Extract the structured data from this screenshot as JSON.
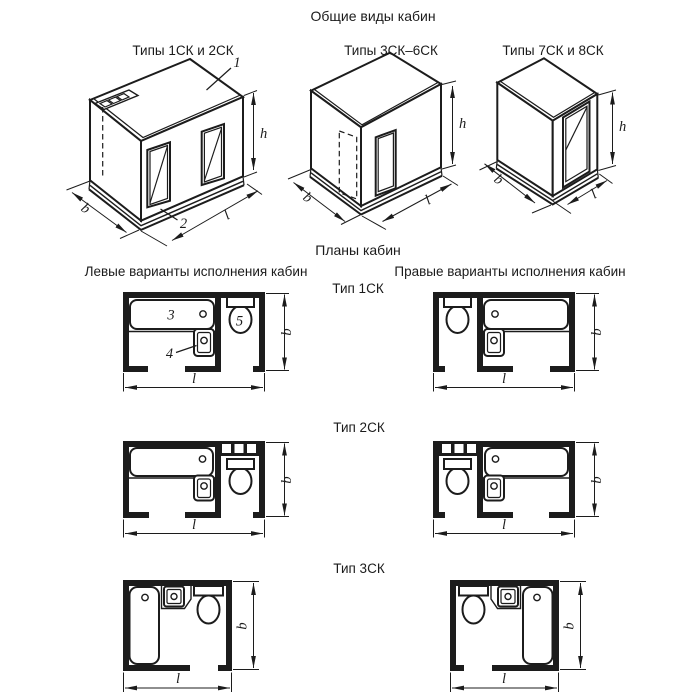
{
  "page": {
    "title": "Общие виды кабин"
  },
  "iso_views": {
    "v1": {
      "label": "Типы 1СК и 2СК"
    },
    "v2": {
      "label": "Типы 3СК–6СК"
    },
    "v3": {
      "label": "Типы 7СК и 8СК"
    }
  },
  "plans": {
    "title": "Планы кабин",
    "left_header": "Левые варианты исполнения кабин",
    "right_header": "Правые варианты исполнения кабин",
    "type1": "Тип 1СК",
    "type2": "Тип 2СК",
    "type3": "Тип 3СК"
  },
  "dims": {
    "b": "b",
    "l": "l",
    "h": "h"
  },
  "callouts": {
    "roof_panel": "1",
    "base": "2",
    "bathtub": "3",
    "washbasin": "4",
    "toilet": "5"
  },
  "colors": {
    "ink": "#1c1c1c",
    "background": "#ffffff"
  }
}
